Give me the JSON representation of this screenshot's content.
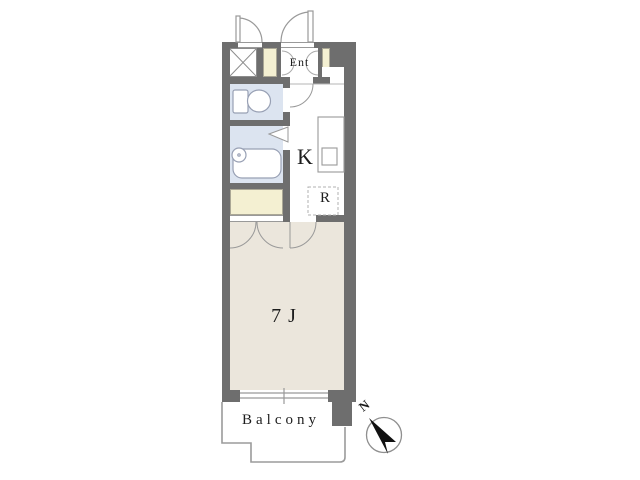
{
  "floorplan": {
    "unit_labels": {
      "entrance": "Ent",
      "kitchen": "K",
      "refrigerator_space": "R",
      "main_room": "7J",
      "balcony": "Balcony",
      "compass_north": "N"
    },
    "colors": {
      "wall": "#6e6e6e",
      "main_room_floor": "#ebe6dc",
      "bath_toilet_floor": "#dce4f0",
      "storage_fill": "#f4f0d2",
      "line": "#999999",
      "compass_needle": "#111111",
      "background": "#ffffff"
    }
  }
}
